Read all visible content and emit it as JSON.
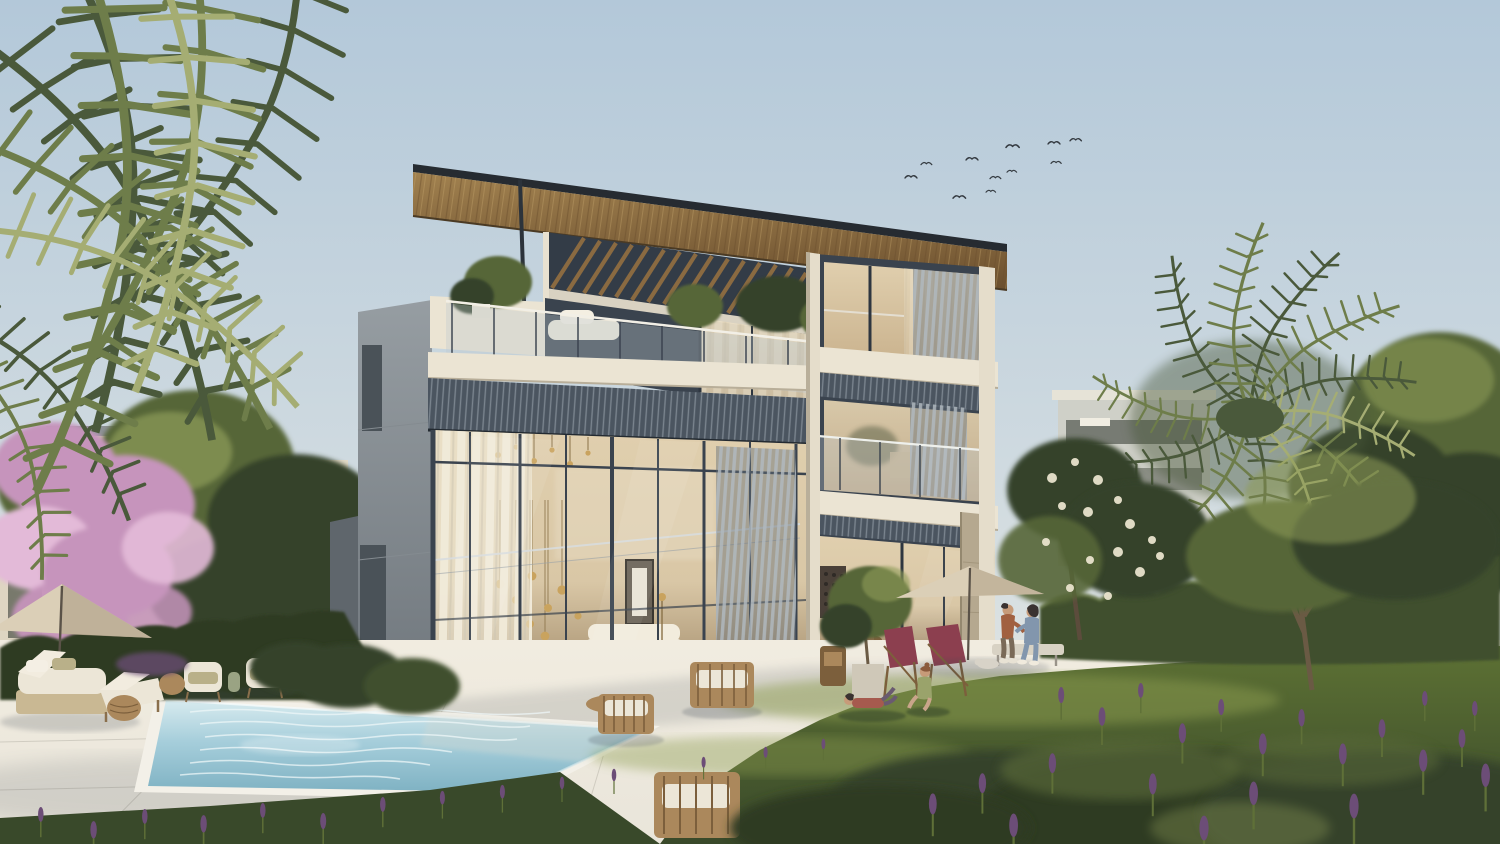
{
  "scene": {
    "description": "Golden-hour architectural rendering of a modern three-storey glass villa with wooden pergola roof, vertical louver screens, swimming pool, stone deck, lawn with family, garden hedges, lavender, blossom tree and palms",
    "elements": [
      {
        "name": "sky",
        "note": "clear gradient sky"
      },
      {
        "name": "birds-flock",
        "note": "eleven distant birds"
      },
      {
        "name": "villa",
        "note": "three-storey modern villa, glass facade, wood roof"
      },
      {
        "name": "pool",
        "note": "rectangular pool on stone deck"
      },
      {
        "name": "family",
        "note": "couple on bench, two children on lawn, small dog"
      },
      {
        "name": "garden",
        "note": "lawn, hedges, lavender, olive tree, blossom tree, palms"
      }
    ],
    "colors": {
      "sky_top": "#b3c8d9",
      "sky_mid": "#cfdae0",
      "sky_horizon": "#e9e9e3",
      "bird": "#343a40",
      "roof_edge": "#262b31",
      "roof_wood": "#a1814f",
      "roof_wood_dark": "#6b4f2e",
      "pergola_recess": "#333c47",
      "pergola_slat": "#8a6a41",
      "facade_cream": "#ebe4d3",
      "facade_shade": "#d3cab6",
      "frame_dark": "#3a434e",
      "frame_mid": "#55606c",
      "corrugated": "#4b5560",
      "corrugated_rib": "#939ca6",
      "louver": "#aab3ba",
      "louver_gap": "#626d78",
      "glass_warm": "#c8b08b",
      "glass_warm_lt": "#e0cfae",
      "glass_cool": "#bdc8cd",
      "curtain": "#f0ead9",
      "interior": "#d9c7a6",
      "interior_deep": "#97805f",
      "gold": "#c9a35e",
      "side_wall": "#969da2",
      "side_wall_dark": "#6e757b",
      "concrete": "#b5a88f",
      "deck": "#e9e5da",
      "deck_lit": "#f1ece0",
      "deck_shadow": "#c6c3ba",
      "pool_edge": "#f3f0e8",
      "pool_light": "#d8ebef",
      "pool_water": "#a6cedb",
      "pool_deep": "#7fb2c3",
      "water_refl": "#eef7f8",
      "lawn": "#5d7134",
      "lawn_lit": "#8c9c4f",
      "lawn_dark": "#39492a",
      "hedge": "#41502e",
      "hedge_lit": "#5f7038",
      "hedge_dark": "#2e3a22",
      "foliage": "#566639",
      "foliage_dark": "#34432a",
      "foliage_lit": "#8f9c59",
      "trunk": "#6b553d",
      "palm": "#6e7d4a",
      "palm_dark": "#4a593b",
      "palm_lit": "#a5ad73",
      "blossom": "#c694bc",
      "blossom_lt": "#e3bad8",
      "lavender": "#6c4d77",
      "umbrella": "#dbcfb7",
      "umbrella_shade": "#b3a48b",
      "chair_maroon": "#8c3f4f",
      "wood": "#ab885c",
      "wood_dark": "#7c5f3c",
      "cushion": "#ece6d7",
      "olive_cushion": "#b9b089",
      "skin": "#c79b79",
      "hair_dark": "#3a3230",
      "man_shirt": "#a16040",
      "denim": "#8296ad",
      "kid_red": "#a65a4e",
      "kid_green": "#9aa36b",
      "dog": "#d8d3c8",
      "shadow": "#3d4752"
    }
  }
}
